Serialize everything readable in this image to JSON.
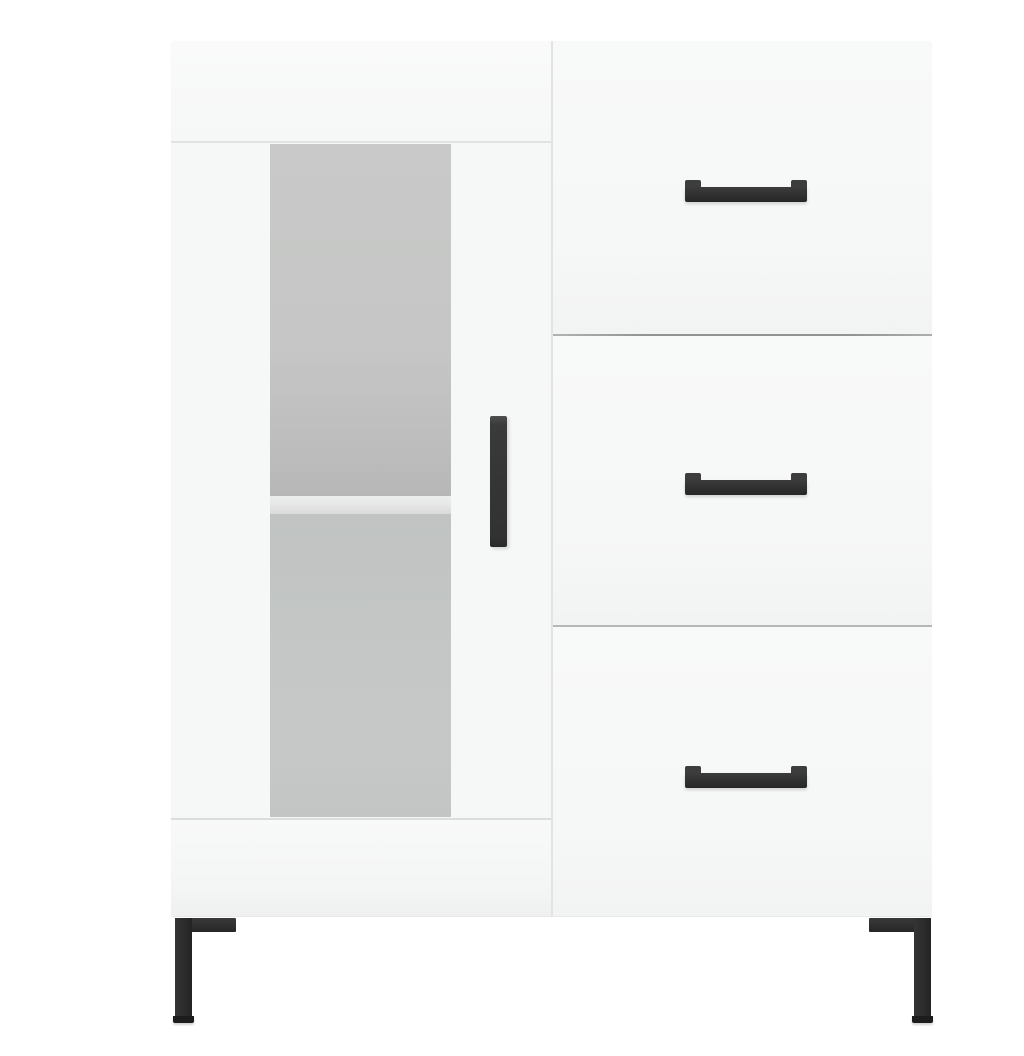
{
  "image": {
    "kind": "product-photo",
    "subject": "White sideboard cabinet with a frosted glass door, three drawers, black bar handles and black L-shaped metal legs on a plain white background",
    "visible_text": "none"
  },
  "colors": {
    "background": "#ffffff",
    "cabinet_body": "#f7f8f8",
    "top_rail": "#fafafa",
    "door_face": "#f6f7f7",
    "drawer_face": "#f6f7f7",
    "glass_upper": "#c8c9c8",
    "glass_shelf": "#e7e8e7",
    "glass_lower": "#c4c7c6",
    "door_bottom_line": "#dcdcdc",
    "seam": "#e3e3e3",
    "divider_dark": "#929292",
    "divider_light": "#b6b6b6",
    "handle": "#323232",
    "handle_highlight": "#4e4e4e",
    "leg": "#2b2b2b",
    "leg_foot": "#1d1d1d"
  },
  "cabinet": {
    "left_section": {
      "type": "glass-door",
      "glass": "frosted, full door height",
      "shelves_visible": 1,
      "handle_style": "vertical black bar"
    },
    "right_section": {
      "type": "drawer-stack",
      "drawer_count": 3,
      "handle_style": "horizontal black bar with end posts"
    },
    "legs": {
      "visible_count": 2,
      "style": "L-shaped metal",
      "color_name": "black"
    }
  }
}
